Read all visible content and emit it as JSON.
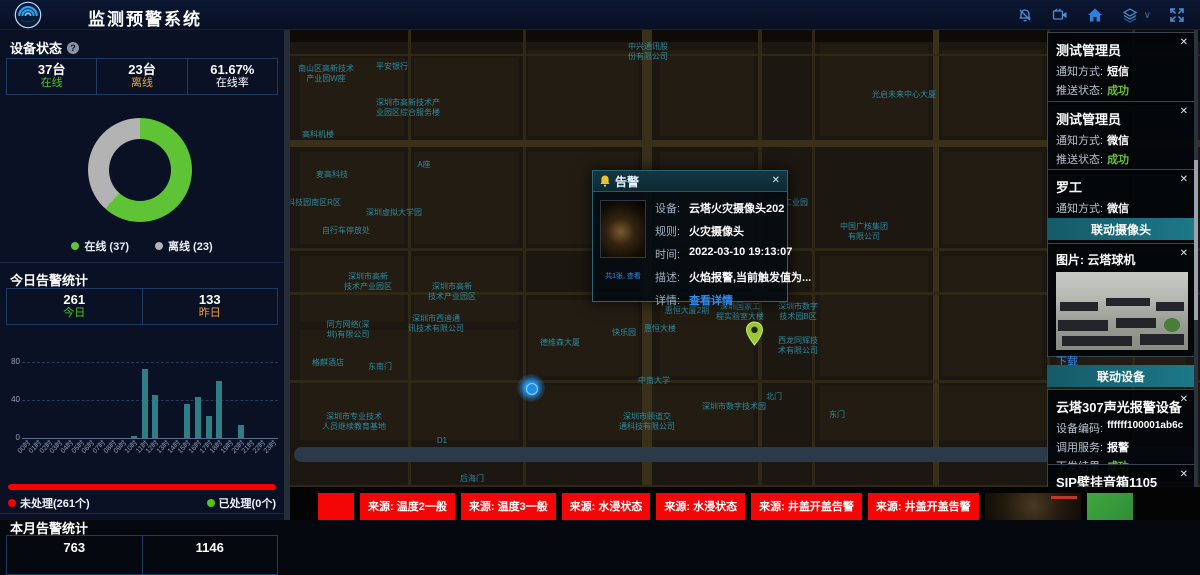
{
  "header": {
    "title": "监测预警系统",
    "icons": [
      "bell-muted-icon",
      "video-camera-icon",
      "home-icon",
      "layers-icon",
      "chevron-down-icon",
      "fullscreen-icon"
    ]
  },
  "device_status": {
    "title": "设备状态",
    "stats": [
      {
        "value": "37台",
        "label": "在线",
        "color": "#4fc41e"
      },
      {
        "value": "23台",
        "label": "离线",
        "color": "#e8a33d"
      },
      {
        "value": "61.67%",
        "label": "在线率",
        "color": "#ffffff"
      }
    ],
    "legend": [
      {
        "label": "在线 (37)",
        "color": "#5fc435"
      },
      {
        "label": "离线 (23)",
        "color": "#b3b3b3"
      }
    ]
  },
  "today_alarm": {
    "title": "今日告警统计",
    "stats": [
      {
        "value": "261",
        "label": "今日",
        "color": "#4fc41e"
      },
      {
        "value": "133",
        "label": "昨日",
        "color": "#e8a33d"
      }
    ],
    "unhandled_label": "未处理(261个)",
    "handled_label": "已处理(0个)",
    "unhandled_color": "#f50000",
    "handled_color": "#52c41a"
  },
  "month_alarm": {
    "title": "本月告警统计",
    "values": [
      "763",
      "1146"
    ]
  },
  "chart_data": [
    {
      "type": "pie",
      "donut": true,
      "title": "设备状态",
      "labels": [
        "在线",
        "离线"
      ],
      "values": [
        37,
        23
      ],
      "colors": [
        "#5fc435",
        "#b3b3b3"
      ],
      "legend_position": "bottom"
    },
    {
      "type": "bar",
      "title": "今日告警统计(按小时)",
      "categories": [
        "00时",
        "01时",
        "02时",
        "03时",
        "04时",
        "05时",
        "06时",
        "07时",
        "08时",
        "09时",
        "10时",
        "11时",
        "12时",
        "13时",
        "14时",
        "15时",
        "16时",
        "17时",
        "18时",
        "19时",
        "20时",
        "21时",
        "22时",
        "23时"
      ],
      "values": [
        0,
        0,
        0,
        0,
        0,
        0,
        0,
        0,
        0,
        0,
        2,
        64,
        40,
        0,
        0,
        32,
        38,
        20,
        53,
        0,
        12,
        0,
        0,
        0
      ],
      "ylim": [
        0,
        80
      ],
      "yticks": [
        0,
        40,
        80
      ],
      "color": "#2f7d85",
      "grid": "dashed"
    }
  ],
  "map": {
    "popup": {
      "title": "告警",
      "photo_caption": "共1张, 查看",
      "fields": [
        {
          "label": "设备:",
          "value": "云塔火灾摄像头202"
        },
        {
          "label": "规则:",
          "value": "火灾摄像头"
        },
        {
          "label": "时间:",
          "value": "2022-03-10 19:13:07"
        },
        {
          "label": "描述:",
          "value": "火焰报警,当前触发值为..."
        },
        {
          "label": "详情:",
          "value": "查看详情"
        }
      ]
    },
    "labels": [
      {
        "x": 358,
        "y": 12,
        "text": "中兴通讯股\n份有限公司"
      },
      {
        "x": 36,
        "y": 34,
        "text": "南山区高新技术\n产业园W座"
      },
      {
        "x": 102,
        "y": 32,
        "text": "平安银行"
      },
      {
        "x": 118,
        "y": 68,
        "text": "深圳市高新技术产\n业园区综合服务楼"
      },
      {
        "x": 614,
        "y": 60,
        "text": "光启未来中心大厦"
      },
      {
        "x": 28,
        "y": 100,
        "text": "高科机楼"
      },
      {
        "x": 134,
        "y": 130,
        "text": "A座"
      },
      {
        "x": 42,
        "y": 140,
        "text": "麦高科技"
      },
      {
        "x": 24,
        "y": 168,
        "text": "科技园南区R区"
      },
      {
        "x": 104,
        "y": 178,
        "text": "深圳虚拟大学园"
      },
      {
        "x": 56,
        "y": 196,
        "text": "自行车停放处"
      },
      {
        "x": 498,
        "y": 168,
        "text": "中兴工业园"
      },
      {
        "x": 440,
        "y": 198,
        "text": "便利店"
      },
      {
        "x": 574,
        "y": 192,
        "text": "中国广核集团\n有限公司"
      },
      {
        "x": 78,
        "y": 242,
        "text": "深圳市高新\n技术产业园区"
      },
      {
        "x": 162,
        "y": 252,
        "text": "深圳市高新\n技术产业园区"
      },
      {
        "x": 58,
        "y": 290,
        "text": "同方网络(深\n圳)有限公司"
      },
      {
        "x": 146,
        "y": 284,
        "text": "深圳市西迪通\n讯技术有限公司"
      },
      {
        "x": 38,
        "y": 328,
        "text": "格麒酒店"
      },
      {
        "x": 90,
        "y": 332,
        "text": "东南门"
      },
      {
        "x": 64,
        "y": 382,
        "text": "深圳市专业技术\n人员继续教育基地"
      },
      {
        "x": 270,
        "y": 308,
        "text": "德维森大厦"
      },
      {
        "x": 334,
        "y": 298,
        "text": "快乐园"
      },
      {
        "x": 370,
        "y": 294,
        "text": "惠恒大楼"
      },
      {
        "x": 397,
        "y": 276,
        "text": "惠恒大厦2期"
      },
      {
        "x": 450,
        "y": 272,
        "text": "深圳国家工\n程实验室大楼"
      },
      {
        "x": 508,
        "y": 272,
        "text": "深圳市数字\n技术园B区"
      },
      {
        "x": 508,
        "y": 306,
        "text": "西龙同辉技\n术有限公司"
      },
      {
        "x": 364,
        "y": 346,
        "text": "中南大学"
      },
      {
        "x": 357,
        "y": 382,
        "text": "深圳市颐道交\n通科技有限公司"
      },
      {
        "x": 444,
        "y": 372,
        "text": "深圳市数字技术园"
      },
      {
        "x": 484,
        "y": 362,
        "text": "北门"
      },
      {
        "x": 547,
        "y": 380,
        "text": "东门"
      },
      {
        "x": 182,
        "y": 444,
        "text": "后海门"
      },
      {
        "x": 152,
        "y": 406,
        "text": "D1"
      }
    ]
  },
  "notifications": [
    {
      "name": "测试管理员",
      "rows": [
        {
          "label": "通知方式:",
          "value": "短信"
        },
        {
          "label": "推送状态:",
          "value": "成功"
        }
      ]
    },
    {
      "name": "测试管理员",
      "rows": [
        {
          "label": "通知方式:",
          "value": "微信"
        },
        {
          "label": "推送状态:",
          "value": "成功"
        }
      ]
    },
    {
      "name": "罗工",
      "rows": [
        {
          "label": "通知方式:",
          "value": "微信"
        },
        {
          "label": "推送状态:",
          "value": "成功"
        }
      ]
    }
  ],
  "linked_camera": {
    "header": "联动摄像头",
    "title": "图片: 云塔球机",
    "download_label": "下载"
  },
  "linked_devices": {
    "header": "联动设备",
    "devices": [
      {
        "title": "云塔307声光报警设备",
        "rows": [
          {
            "label": "设备编码:",
            "value": "ffffff100001ab6c"
          },
          {
            "label": "调用服务:",
            "value": "报警"
          },
          {
            "label": "下发结果:",
            "value": "成功"
          }
        ]
      },
      {
        "title": "SIP壁挂音箱1105",
        "rows": [
          {
            "label": "设备编码:",
            "value": "1105"
          }
        ]
      }
    ]
  },
  "ticker": {
    "items": [
      "来源: 温度2一般",
      "来源: 温度3一般",
      "来源: 水浸状态",
      "来源: 水浸状态",
      "来源: 井盖开盖告警",
      "来源: 井盖开盖告警"
    ]
  }
}
